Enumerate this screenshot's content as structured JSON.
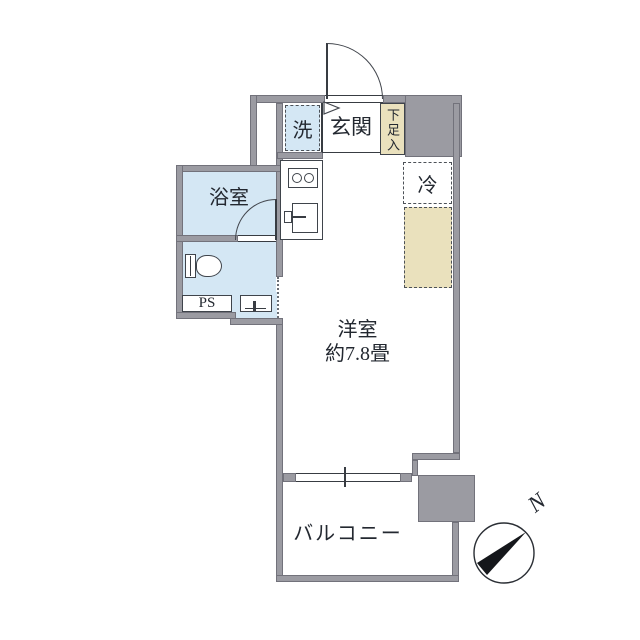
{
  "floorplan": {
    "rooms": {
      "washer": "洗",
      "entrance": "玄関",
      "shoe_cabinet": "下足入",
      "refrigerator": "冷",
      "bathroom": "浴室",
      "pipe_space": "PS",
      "main_room_name": "洋室",
      "main_room_size": "約7.8畳",
      "balcony": "バルコニー"
    },
    "compass": {
      "north_label": "N"
    },
    "colors": {
      "wall": "#9b9ba2",
      "wet_area": "#d4e7f4",
      "storage": "#eae1bd",
      "line": "#383c42"
    }
  }
}
